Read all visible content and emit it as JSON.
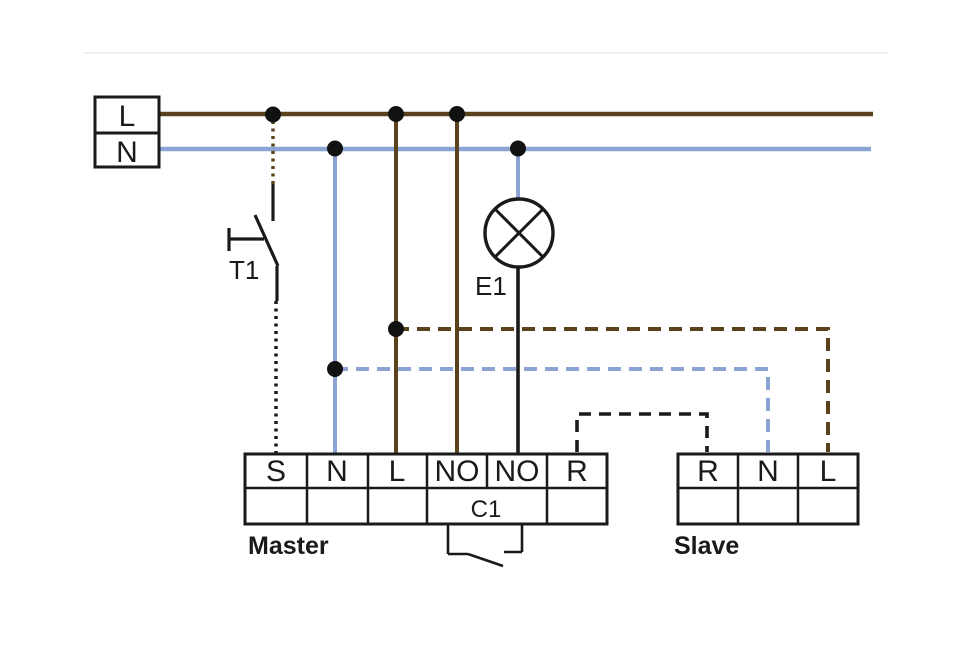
{
  "diagram": {
    "title": "Master / Slave wiring diagram",
    "source": {
      "terminals": {
        "live": "L",
        "neutral": "N"
      }
    },
    "switch": {
      "label": "T1"
    },
    "lamp": {
      "label": "E1"
    },
    "master": {
      "caption": "Master",
      "terminals": [
        "S",
        "N",
        "L",
        "NO",
        "NO",
        "R"
      ],
      "relay_label": "C1"
    },
    "slave": {
      "caption": "Slave",
      "terminals": [
        "R",
        "N",
        "L"
      ]
    },
    "colors": {
      "line_brown": "#5a421c",
      "line_blue": "#8ba4d3",
      "line_black": "#1a1a1a",
      "hairline_gray": "#eaeaea"
    }
  }
}
